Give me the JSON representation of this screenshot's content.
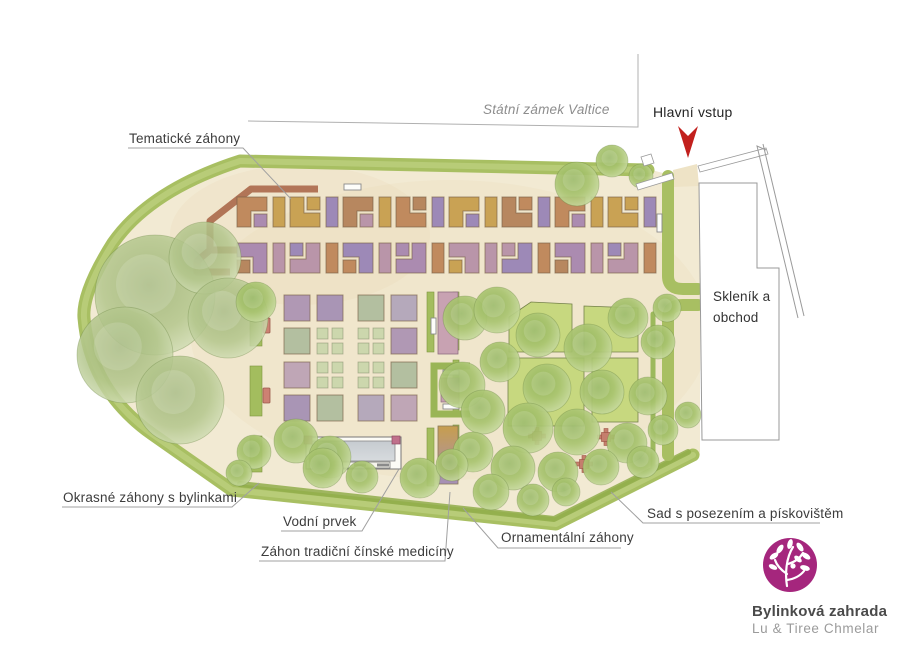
{
  "labels": {
    "castle": "Státní zámek Valtice",
    "main_entrance": "Hlavní vstup",
    "thematic_beds": "Tematické záhony",
    "greenhouse_shop": "Skleník a obchod",
    "ornamental_herb_beds": "Okrasné záhony s bylinkami",
    "water_feature": "Vodní prvek",
    "chinese_medicine_bed": "Záhon tradiční čínské medicíny",
    "ornamental_beds": "Ornamentální záhony",
    "orchard": "Sad s posezením a pískovištěm"
  },
  "logo": {
    "title": "Bylinková zahrada",
    "subtitle": "Lu & Tiree Chmelar",
    "color": "#a5267d"
  },
  "colors": {
    "path_beige": "#f2ead3",
    "boundary_green": "#a8bf62",
    "boundary_light": "#bccf7e",
    "hedge_green": "#90ad4a",
    "strip_green": "#a3bd5e",
    "lawn_green": "#c7d87f",
    "pergola_brown": "#a76243",
    "water_gray": "#ccd1d4",
    "furniture_red": "#c57e6d",
    "arrow_red": "#c2201d",
    "bed_palette": [
      "#c08a5e",
      "#ab8bb0",
      "#c9a254",
      "#b995a9",
      "#b7875f",
      "#9d89b7"
    ],
    "central_palette": [
      "#b098b4",
      "#b3bfa0",
      "#bfa6b6",
      "#a995b5",
      "#b5a9bb"
    ],
    "quartet_green": "#ccd7ad"
  },
  "icons": {
    "entrance_arrow": "red-down-arrow-icon",
    "logo_mark": "herb-tree-icon"
  }
}
